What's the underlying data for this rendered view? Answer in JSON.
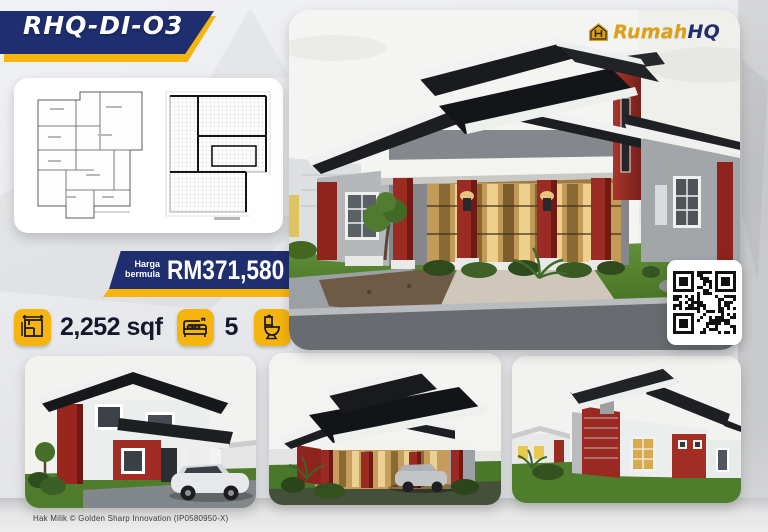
{
  "banner": {
    "model_code": "RHQ-DI-O3"
  },
  "logo": {
    "brand_gold": "Rumah",
    "brand_navy": "HQ"
  },
  "price": {
    "label_line1": "Harga",
    "label_line2": "bermula",
    "amount": "RM371,580"
  },
  "specs": {
    "area": {
      "icon": "area-icon",
      "value": "2,252 sqf"
    },
    "bedrooms": {
      "icon": "bed-icon",
      "value": "5"
    },
    "bathrooms": {
      "icon": "toilet-icon",
      "value": "4"
    }
  },
  "footer": {
    "copyright": "Hak Milik © Golden Sharp Innovation (IP0580950-X)"
  },
  "colors": {
    "navy": "#1e2e6e",
    "yellow": "#f6b40f",
    "logo_gold": "#dd9f13",
    "accent_red": "#9b2a22"
  }
}
